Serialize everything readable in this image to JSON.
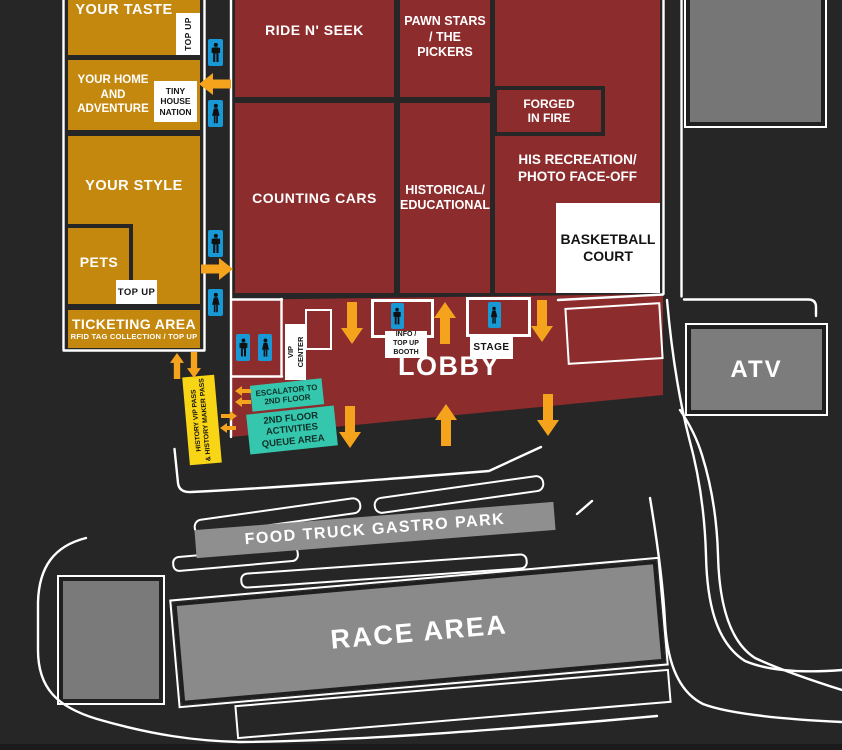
{
  "palette": {
    "background": "#262626",
    "zone_gold": "#C5880E",
    "zone_red": "#8D2C2C",
    "zone_gray": "#7C7C7C",
    "arrow_yellow": "#F5A31C",
    "restroom_blue": "#1898D5",
    "label_teal": "#35C7AE",
    "pass_yellow": "#F8D515",
    "road_white": "#FFFFFF"
  },
  "icons": {
    "restroom_male": "male-restroom-icon",
    "restroom_female": "female-restroom-icon",
    "direction": "direction-arrow-icon"
  },
  "left_wing": {
    "your_taste": "YOUR TASTE",
    "taste_top_up": "TOP UP",
    "your_home": [
      "YOUR HOME",
      "AND",
      "ADVENTURE"
    ],
    "tiny_house": [
      "TINY",
      "HOUSE",
      "NATION"
    ],
    "your_style": "YOUR STYLE",
    "pets": "PETS",
    "pets_top_up": "TOP UP",
    "ticketing_title": "TICKETING AREA",
    "ticketing_subtitle": "RFID TAG COLLECTION / TOP UP"
  },
  "main_hall": {
    "ride_n_seek": "RIDE N' SEEK",
    "pawn_stars": [
      "PAWN STARS",
      "/ THE PICKERS"
    ],
    "forged_in_fire": [
      "FORGED",
      "IN FIRE"
    ],
    "his_recreation": [
      "HIS RECREATION/",
      "PHOTO FACE-OFF"
    ],
    "basketball_court": [
      "BASKETBALL",
      "COURT"
    ],
    "counting_cars": "COUNTING CARS",
    "historical": [
      "HISTORICAL/",
      "EDUCATIONAL"
    ]
  },
  "lobby": {
    "title": "LOBBY",
    "vip_center": [
      "VIP",
      "CENTER"
    ],
    "info_booth": [
      "INFO /",
      "TOP UP",
      "BOOTH"
    ],
    "stage": "STAGE",
    "escalator": [
      "ESCALATOR TO",
      "2ND FLOOR"
    ],
    "queue": [
      "2ND FLOOR",
      "ACTIVITIES",
      "QUEUE AREA"
    ],
    "vip_pass": [
      "HISTORY VIP PASS",
      "& HISTORY MAKER PASS"
    ]
  },
  "outdoor": {
    "atv": "ATV",
    "food_truck": "FOOD TRUCK GASTRO PARK",
    "race_area": "RACE AREA"
  }
}
